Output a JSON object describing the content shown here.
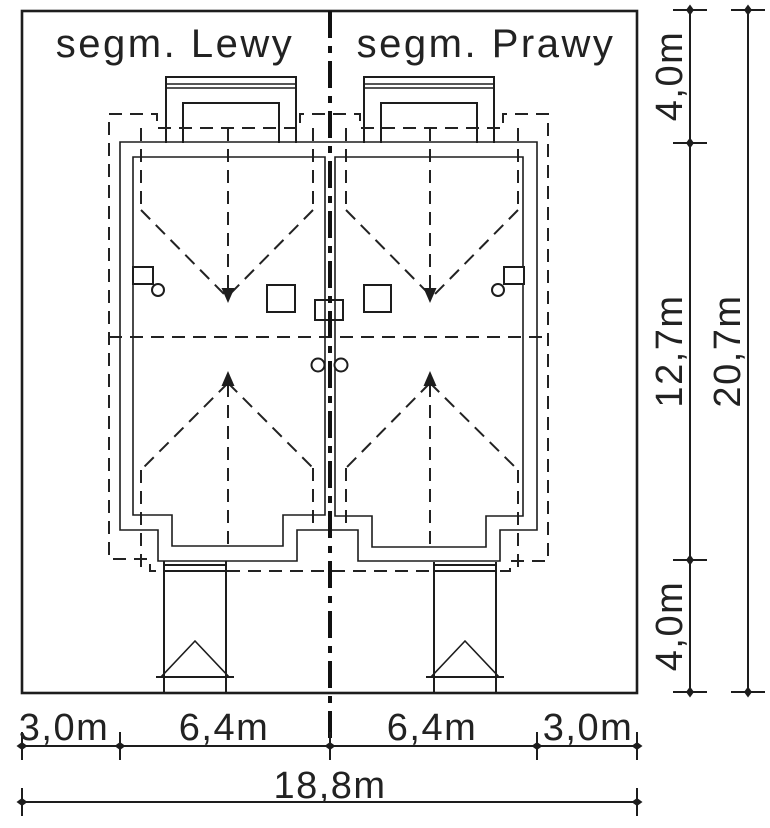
{
  "drawing_title": {
    "left_segment_label": "segm. Lewy",
    "right_segment_label": "segm. Prawy"
  },
  "dimensions": {
    "bottom": {
      "left_margin": "3,0m",
      "left_segment_width": "6,4m",
      "right_segment_width": "6,4m",
      "right_margin": "3,0m",
      "total_width": "18,8m"
    },
    "right": {
      "top_margin": "4,0m",
      "building_depth": "12,7m",
      "bottom_margin": "4,0m",
      "total_depth": "20,7m"
    }
  },
  "colors": {
    "wall_fill": "#4d4d4d",
    "line": "#1d1d1d",
    "background": "#ffffff"
  }
}
